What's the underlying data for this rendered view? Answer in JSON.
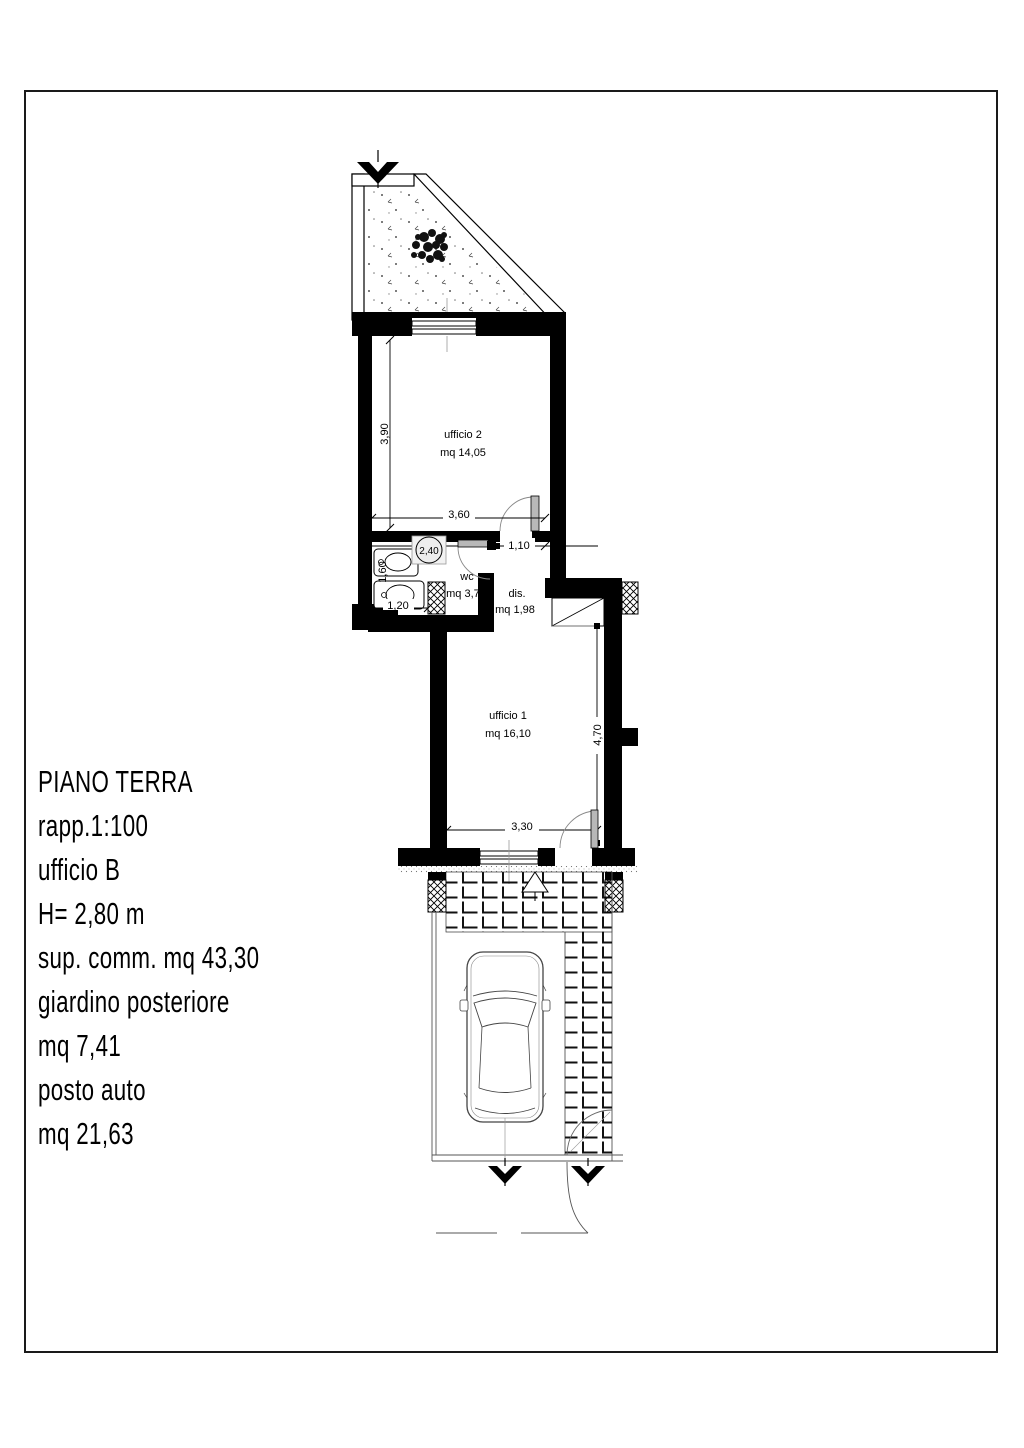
{
  "info_panel": {
    "lines": [
      "PIANO TERRA",
      "rapp.1:100",
      "ufficio B",
      "H= 2,80 m",
      "sup. comm. mq 43,30",
      "giardino posteriore",
      "mq 7,41",
      "posto auto",
      "mq 21,63"
    ]
  },
  "plan": {
    "rooms": [
      {
        "name": "ufficio 2",
        "area": "mq 14,05"
      },
      {
        "name": "wc",
        "area": "mq 3,73"
      },
      {
        "name": "dis.",
        "area": "mq 1,98"
      },
      {
        "name": "ufficio 1",
        "area": "mq 16,10"
      }
    ],
    "dimensions": {
      "u2_width": "3,60",
      "u2_depth": "3,90",
      "door_circle": "2,40",
      "entry_offset": "1,10",
      "wc_depth": "1,60",
      "wc_width": "1,20",
      "u1_depth": "4,70",
      "u1_width": "3,30"
    },
    "colors": {
      "wall": "#000000",
      "door_leaf": "#b8b8b8",
      "paper": "#ffffff",
      "thin_line": "#555555"
    }
  }
}
